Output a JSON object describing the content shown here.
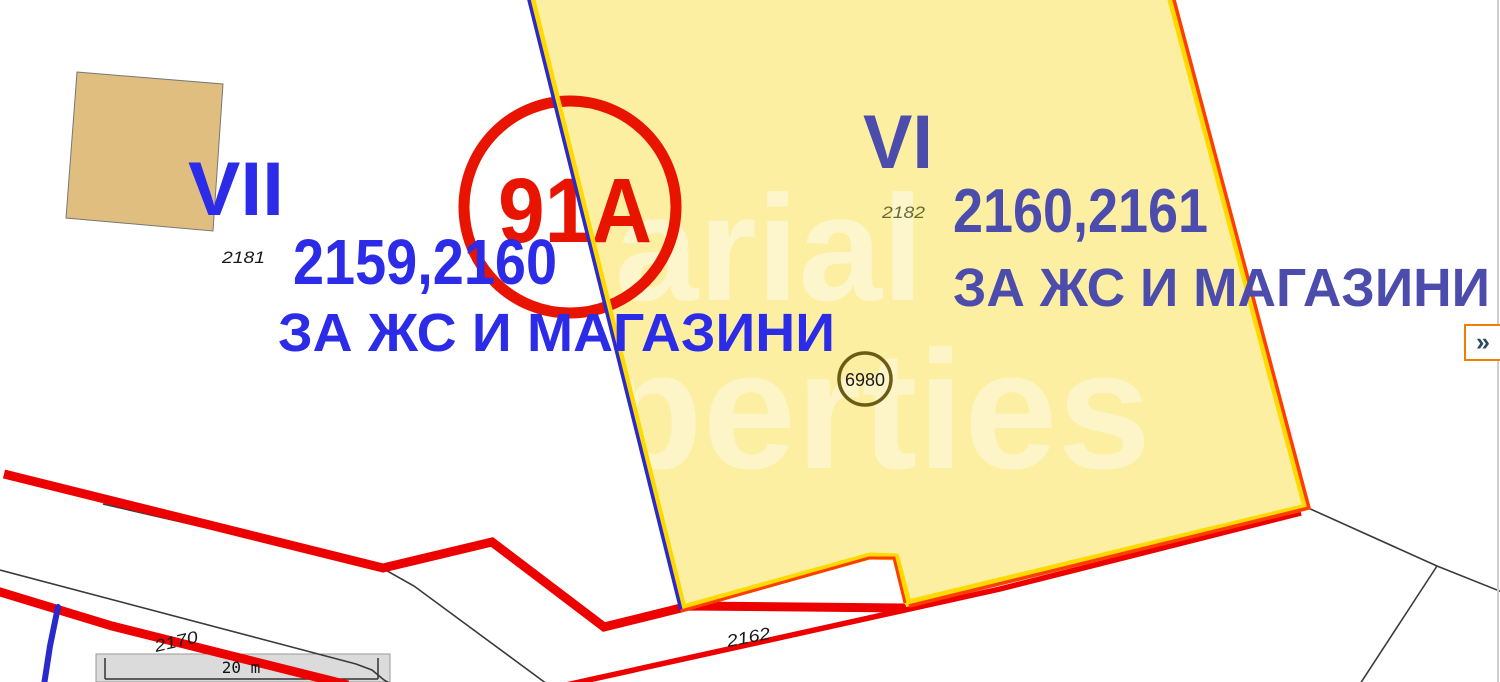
{
  "map": {
    "title": "cadastral-map-view",
    "parcel_vii": {
      "roman": "VII",
      "cad_no": "2181",
      "numbers": "2159,2160",
      "designation": "ЗА ЖС И МАГАЗИНИ"
    },
    "parcel_vi": {
      "roman": "VI",
      "cad_no": "2182",
      "numbers": "2160,2161",
      "designation": "ЗА ЖС И МАГАЗИНИ",
      "point_label": "6980"
    },
    "plot_circle_label": "91А",
    "road_label_1": "2170",
    "road_label_2": "2162",
    "scale_bar": {
      "label": "20 m"
    },
    "expand_button": {
      "label": "»"
    },
    "watermark": {
      "line1": "arial",
      "line2": "perties"
    },
    "colors": {
      "parcel_fill": "#FCEFA2",
      "parcel_border": "#FFD900",
      "regulation_blue": "#2929CC",
      "boundary_red": "#FF3D00",
      "road_red": "#ED0000",
      "circle_red": "#E81400",
      "label_blue": "#2B2BE8",
      "label_blue_muted": "#4C4CAC",
      "point_olive": "#6B5B14",
      "building_tan": "#DFBE80",
      "cad_text": "#1A1A1A",
      "cad_text_olive": "#6B6B35"
    }
  }
}
